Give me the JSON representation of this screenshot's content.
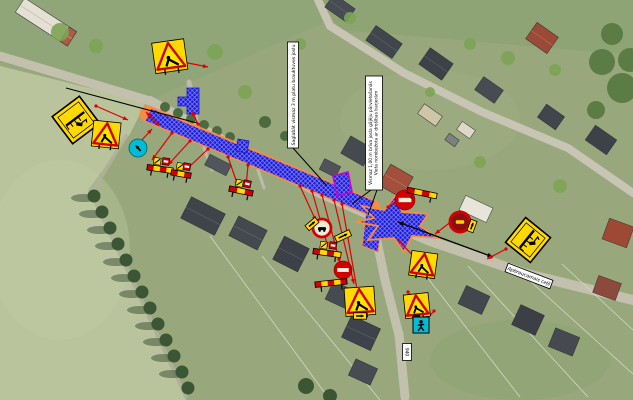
{
  "colors": {
    "work_zone_blue": "#1a1ad4",
    "work_zone_hatch": "#8a8aff",
    "work_zone_outline": "#ff8a3c",
    "arrow_red": "#e00000",
    "leader_black": "#000000",
    "sign_yellow": "#ffd900",
    "sign_red": "#d40000",
    "sign_cyan": "#00bcd4",
    "trench_magenta": "#cc00cc",
    "label_bg": "#ffffff",
    "label_border": "#000000"
  },
  "labels": {
    "note_lane": {
      "text": "Saglabāt vismaz 3 m platu brauktuves joslu",
      "x": 293,
      "y": 95,
      "w": 11,
      "h": 106
    },
    "note_pedestrian": {
      "line1": "Vismaz 1,00 m brīva josla gājēju pārvietošanās",
      "line2": "Vieta norobežota ar drošības barjerām",
      "x": 374,
      "y": 133,
      "w": 17,
      "h": 114
    },
    "street": {
      "text": "Apbraucamais ceļš",
      "x": 529,
      "y": 276,
      "rot": 21,
      "w": 48,
      "h": 9
    },
    "code_tag": {
      "text": "940",
      "x": 407,
      "y": 352,
      "w": 9,
      "h": 17
    }
  },
  "zones": {
    "main_band": [
      [
        151,
        108
      ],
      [
        375,
        201
      ],
      [
        369,
        215
      ],
      [
        145,
        121
      ]
    ],
    "band_axis": [
      148,
      114,
      372,
      208
    ],
    "intersection_star": [
      [
        362,
        206
      ],
      [
        384,
        210
      ],
      [
        395,
        196
      ],
      [
        402,
        212
      ],
      [
        428,
        214
      ],
      [
        420,
        226
      ],
      [
        438,
        238
      ],
      [
        412,
        236
      ],
      [
        404,
        252
      ],
      [
        394,
        238
      ],
      [
        368,
        240
      ],
      [
        378,
        226
      ],
      [
        356,
        222
      ],
      [
        374,
        218
      ]
    ],
    "south_stub": [
      [
        366,
        214
      ],
      [
        382,
        220
      ],
      [
        378,
        252
      ],
      [
        362,
        246
      ]
    ],
    "north_T": [
      [
        187,
        88
      ],
      [
        199,
        88
      ],
      [
        199,
        114
      ],
      [
        187,
        114
      ],
      [
        187,
        106
      ],
      [
        178,
        106
      ],
      [
        178,
        97
      ],
      [
        187,
        97
      ]
    ],
    "small_patch": [
      [
        238,
        139
      ],
      [
        249,
        141
      ],
      [
        247,
        153
      ],
      [
        236,
        151
      ]
    ],
    "trench_patch": [
      [
        333,
        176
      ],
      [
        348,
        172
      ],
      [
        352,
        192
      ],
      [
        337,
        196
      ]
    ]
  },
  "signs": [
    {
      "id": "info-board-left",
      "type": "diamond",
      "x": 76,
      "y": 120,
      "size": 34,
      "rot": 8
    },
    {
      "id": "info-board-right",
      "type": "diamond",
      "x": 528,
      "y": 240,
      "size": 32,
      "rot": -6
    },
    {
      "id": "roadworks-top",
      "type": "triangle",
      "x": 170,
      "y": 58,
      "size": 26,
      "rot": -8,
      "board": true
    },
    {
      "id": "roadworks-left",
      "type": "triangle",
      "x": 106,
      "y": 136,
      "size": 22,
      "rot": 6,
      "board": true
    },
    {
      "id": "roadworks-south1",
      "type": "triangle",
      "x": 360,
      "y": 303,
      "size": 24,
      "rot": -4,
      "board": true
    },
    {
      "id": "roadworks-south2",
      "type": "triangle",
      "x": 423,
      "y": 266,
      "size": 21,
      "rot": 8,
      "board": true
    },
    {
      "id": "roadworks-south3",
      "type": "triangle",
      "x": 417,
      "y": 307,
      "size": 20,
      "rot": -6,
      "board": true
    },
    {
      "id": "mandatory-left",
      "type": "mandatory",
      "x": 138,
      "y": 148,
      "size": 9
    },
    {
      "id": "ped-crossing",
      "type": "pedcross",
      "x": 421,
      "y": 325,
      "size": 16
    },
    {
      "id": "no-entry-north",
      "type": "noentry",
      "x": 405,
      "y": 200,
      "size": 10
    },
    {
      "id": "no-entry-south",
      "type": "noentry",
      "x": 343,
      "y": 270,
      "size": 9
    },
    {
      "id": "prohibit-center",
      "type": "prohibit",
      "x": 322,
      "y": 228,
      "size": 9,
      "variant": "dark"
    },
    {
      "id": "prohibit-east",
      "type": "prohibit",
      "x": 460,
      "y": 222,
      "size": 10,
      "variant": "car"
    },
    {
      "id": "barrier-1",
      "type": "barrier",
      "x": 160,
      "y": 169,
      "w": 26,
      "rot": 8,
      "minis": true
    },
    {
      "id": "barrier-2",
      "type": "barrier",
      "x": 181,
      "y": 174,
      "w": 20,
      "rot": 10,
      "minis": true
    },
    {
      "id": "barrier-3",
      "type": "barrier",
      "x": 241,
      "y": 191,
      "w": 24,
      "rot": 12,
      "minis": true
    },
    {
      "id": "barrier-4",
      "type": "barrier",
      "x": 327,
      "y": 253,
      "w": 28,
      "rot": 8,
      "minis": true
    },
    {
      "id": "barrier-5",
      "type": "barrier",
      "x": 422,
      "y": 193,
      "w": 30,
      "rot": 12,
      "minis": false
    },
    {
      "id": "barrier-6",
      "type": "barrier",
      "x": 331,
      "y": 283,
      "w": 32,
      "rot": -6,
      "minis": false
    },
    {
      "id": "plate-1",
      "type": "plate",
      "x": 343,
      "y": 236,
      "w": 16,
      "rot": -25
    },
    {
      "id": "plate-2",
      "type": "plate",
      "x": 312,
      "y": 224,
      "w": 13,
      "rot": -40
    },
    {
      "id": "plate-3",
      "type": "plate",
      "x": 472,
      "y": 226,
      "w": 12,
      "rot": -70
    },
    {
      "id": "plate-4",
      "type": "plate",
      "x": 360,
      "y": 316,
      "w": 13,
      "rot": 0
    }
  ],
  "arrows": {
    "red": [
      [
        178,
        61,
        208,
        67
      ],
      [
        96,
        106,
        128,
        120
      ],
      [
        140,
        142,
        152,
        129
      ],
      [
        158,
        124,
        146,
        112
      ],
      [
        172,
        133,
        152,
        160
      ],
      [
        190,
        141,
        168,
        165
      ],
      [
        208,
        149,
        186,
        170
      ],
      [
        228,
        157,
        238,
        186
      ],
      [
        248,
        165,
        246,
        187
      ],
      [
        300,
        186,
        316,
        221
      ],
      [
        312,
        191,
        328,
        247
      ],
      [
        322,
        195,
        340,
        263
      ],
      [
        334,
        200,
        354,
        284
      ],
      [
        342,
        204,
        358,
        295
      ],
      [
        388,
        207,
        402,
        197
      ],
      [
        452,
        221,
        435,
        234
      ],
      [
        506,
        249,
        487,
        259
      ],
      [
        408,
        292,
        417,
        302
      ],
      [
        434,
        311,
        425,
        321
      ],
      [
        198,
        124,
        192,
        111
      ],
      [
        400,
        242,
        418,
        261
      ]
    ],
    "black_leaders": [
      [
        66,
        88,
        197,
        123
      ],
      [
        293,
        148,
        327,
        186
      ],
      [
        371,
        190,
        352,
        204
      ],
      [
        377,
        190,
        368,
        215
      ]
    ],
    "pedestrian_route": [
      398,
      222,
      493,
      257
    ]
  }
}
